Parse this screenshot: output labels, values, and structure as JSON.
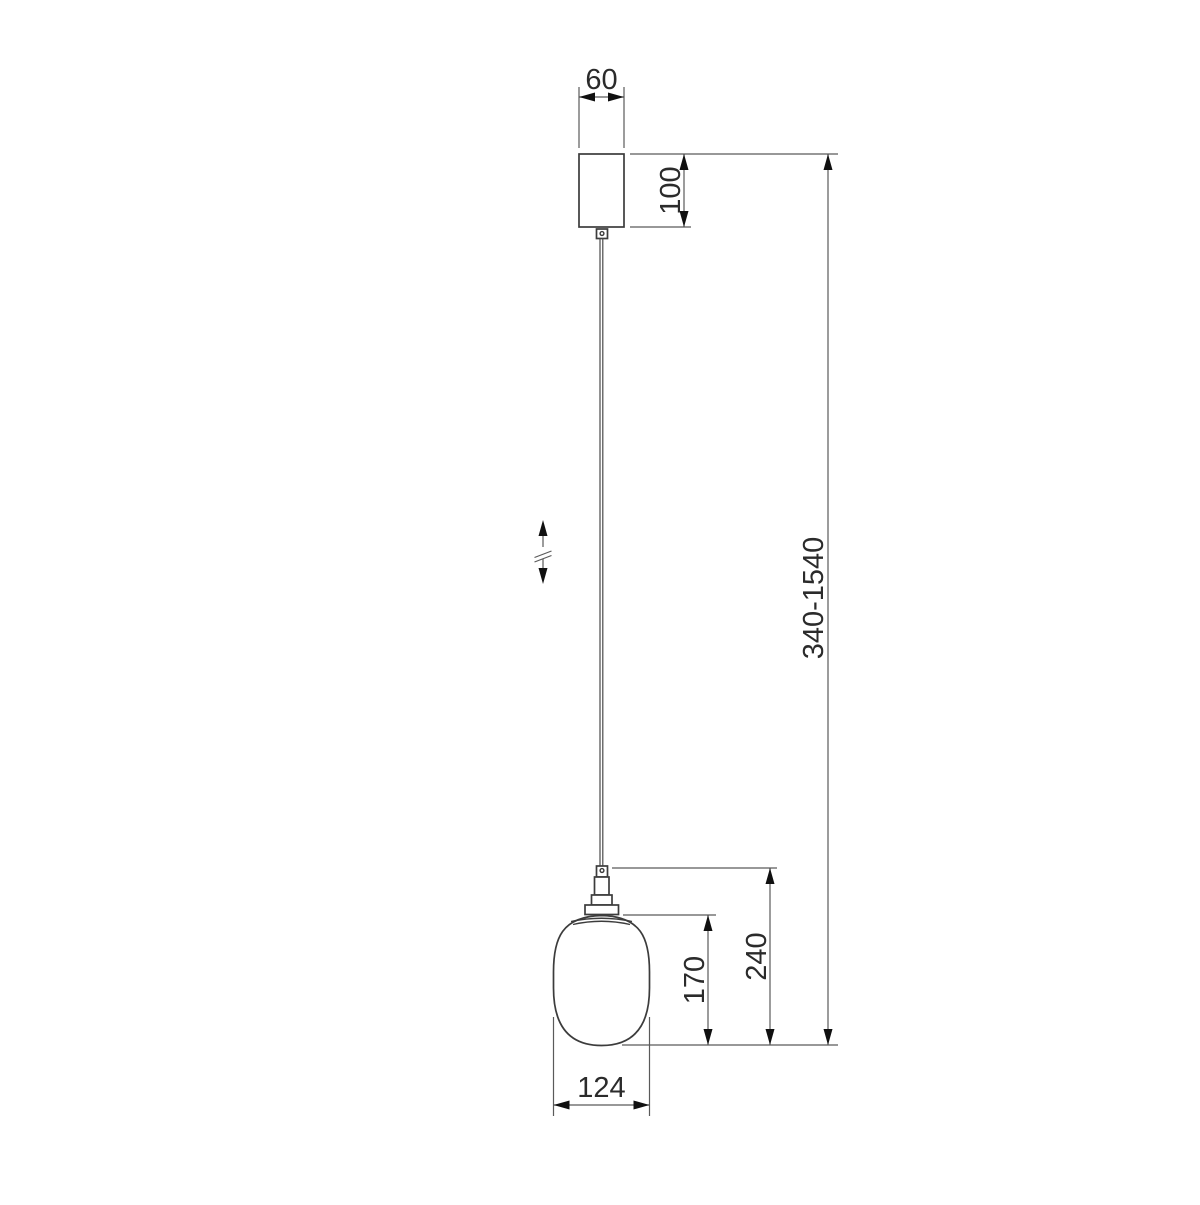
{
  "drawing": {
    "background": "#ffffff",
    "object_line_color": "#3c3c3c",
    "dimension_line_color": "#5a5a5a",
    "arrow_color": "#101010",
    "text_color": "#2b2b2b",
    "labels": {
      "canopy_width": "60",
      "canopy_height": "100",
      "overall_height_range": "340-1540",
      "fixture_drop_height": "240",
      "shade_height": "170",
      "shade_width": "124"
    }
  }
}
